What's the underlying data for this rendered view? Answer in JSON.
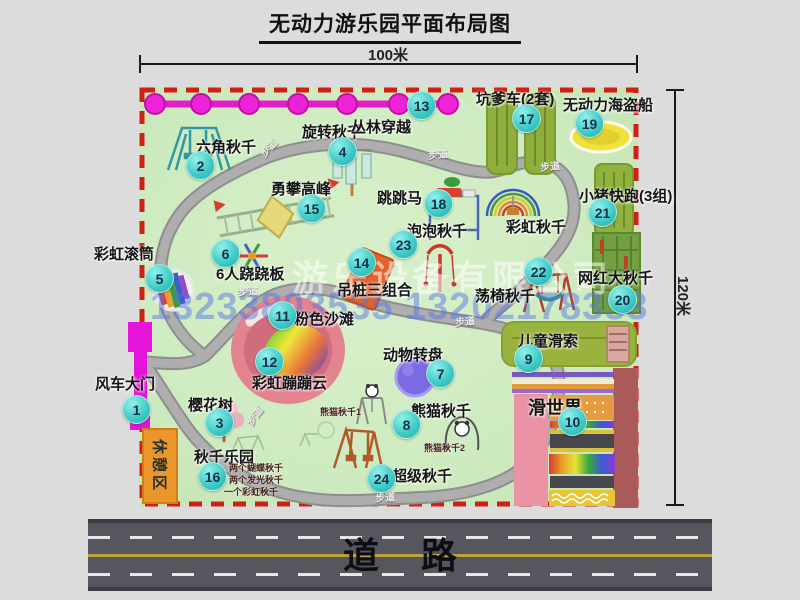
{
  "title": "无动力游乐园平面布局图",
  "dimensions": {
    "width_label": "100米",
    "height_label": "120米"
  },
  "watermark": {
    "company": "游乐设备有限公司",
    "phones": "13233803535 13202178333"
  },
  "road": {
    "label": "道路"
  },
  "rest_area": {
    "label": "休憩区"
  },
  "colors": {
    "map_green": "#cdeabf",
    "border_red": "#d01f14",
    "badge_teal": "#3cc9c4",
    "chain_magenta": "#e61cc8",
    "road_gray": "#56565e",
    "gate_magenta": "#e414d8",
    "rest_orange": "#eb962b",
    "watermark_blue": "#5474e4"
  },
  "map": {
    "attractions": [
      {
        "num": "1",
        "label": "风车大门",
        "label_x": 95,
        "label_y": 373,
        "bx": 135,
        "by": 408
      },
      {
        "num": "2",
        "label": "六角秋千",
        "label_x": 196,
        "label_y": 136,
        "bx": 199,
        "by": 164
      },
      {
        "num": "3",
        "label": "樱花树",
        "label_x": 188,
        "label_y": 394,
        "bx": 218,
        "by": 421
      },
      {
        "num": "4",
        "label": "旋转秋千",
        "label_x": 302,
        "label_y": 121,
        "bx": 341,
        "by": 150
      },
      {
        "num": "5",
        "label": "彩虹滚筒",
        "label_x": 94,
        "label_y": 243,
        "bx": 158,
        "by": 277
      },
      {
        "num": "6",
        "label": "6人跷跷板",
        "label_x": 216,
        "label_y": 263,
        "bx": 224,
        "by": 252
      },
      {
        "num": "7",
        "label": "动物转盘",
        "label_x": 383,
        "label_y": 344,
        "bx": 439,
        "by": 372
      },
      {
        "num": "8",
        "label": "熊猫秋千",
        "label_x": 411,
        "label_y": 400,
        "bx": 405,
        "by": 423
      },
      {
        "num": "9",
        "label": "儿童滑索",
        "label_x": 518,
        "label_y": 330,
        "bx": 527,
        "by": 357
      },
      {
        "num": "10",
        "label": "滑世界",
        "label_x": 528,
        "label_y": 394,
        "bx": 571,
        "by": 420,
        "size": 18
      },
      {
        "num": "11",
        "label": "粉色沙滩",
        "label_x": 294,
        "label_y": 308,
        "bx": 281,
        "by": 314
      },
      {
        "num": "12",
        "label": "彩虹蹦蹦云",
        "label_x": 252,
        "label_y": 372,
        "bx": 268,
        "by": 360
      },
      {
        "num": "13",
        "label": "丛林穿越",
        "label_x": 351,
        "label_y": 116,
        "bx": 420,
        "by": 104
      },
      {
        "num": "14",
        "label": "吊桩三组合",
        "label_x": 337,
        "label_y": 279,
        "bx": 360,
        "by": 261
      },
      {
        "num": "15",
        "label": "勇攀高峰",
        "label_x": 271,
        "label_y": 178,
        "bx": 310,
        "by": 207
      },
      {
        "num": "16",
        "label": "秋千乐园",
        "label_x": 194,
        "label_y": 446,
        "bx": 211,
        "by": 475
      },
      {
        "num": "17",
        "label": "坑爹车(2套)",
        "label_x": 476,
        "label_y": 88,
        "bx": 525,
        "by": 117
      },
      {
        "num": "18",
        "label": "跳跳马",
        "label_x": 377,
        "label_y": 187,
        "bx": 437,
        "by": 202
      },
      {
        "num": "19",
        "label": "无动力海盗船",
        "label_x": 563,
        "label_y": 94,
        "bx": 588,
        "by": 122
      },
      {
        "num": "20",
        "label": "网红大秋千",
        "label_x": 578,
        "label_y": 267,
        "bx": 621,
        "by": 298
      },
      {
        "num": "21",
        "label": "小猪快跑(3组)",
        "label_x": 579,
        "label_y": 185,
        "bx": 601,
        "by": 211
      },
      {
        "num": "22",
        "label": "荡椅秋千",
        "label_x": 475,
        "label_y": 285,
        "bx": 537,
        "by": 270
      },
      {
        "num": "23",
        "label": "泡泡秋千",
        "label_x": 407,
        "label_y": 220,
        "bx": 402,
        "by": 243
      },
      {
        "num": "24",
        "label": "超级秋千",
        "label_x": 392,
        "label_y": 465,
        "bx": 380,
        "by": 477
      }
    ],
    "extra_labels": [
      {
        "text": "彩虹秋千",
        "x": 506,
        "y": 216
      }
    ],
    "sub_labels": [
      {
        "text": "熊猫秋千1",
        "x": 320,
        "y": 405
      },
      {
        "text": "熊猫秋千2",
        "x": 424,
        "y": 441
      },
      {
        "text": "两个蝴蝶秋千",
        "x": 229,
        "y": 461
      },
      {
        "text": "两个发光秋千",
        "x": 229,
        "y": 473
      },
      {
        "text": "一个彩虹秋千",
        "x": 224,
        "y": 485
      }
    ],
    "path_labels": [
      {
        "text": "步道",
        "x": 258,
        "y": 140,
        "rot": -48
      },
      {
        "text": "步道",
        "x": 428,
        "y": 146,
        "rot": -6
      },
      {
        "text": "步道",
        "x": 540,
        "y": 158,
        "rot": -6
      },
      {
        "text": "步道",
        "x": 238,
        "y": 283,
        "rot": -4
      },
      {
        "text": "步道",
        "x": 455,
        "y": 313,
        "rot": -6
      },
      {
        "text": "步道",
        "x": 244,
        "y": 408,
        "rot": -55
      },
      {
        "text": "步道",
        "x": 375,
        "y": 489,
        "rot": -4
      }
    ]
  }
}
